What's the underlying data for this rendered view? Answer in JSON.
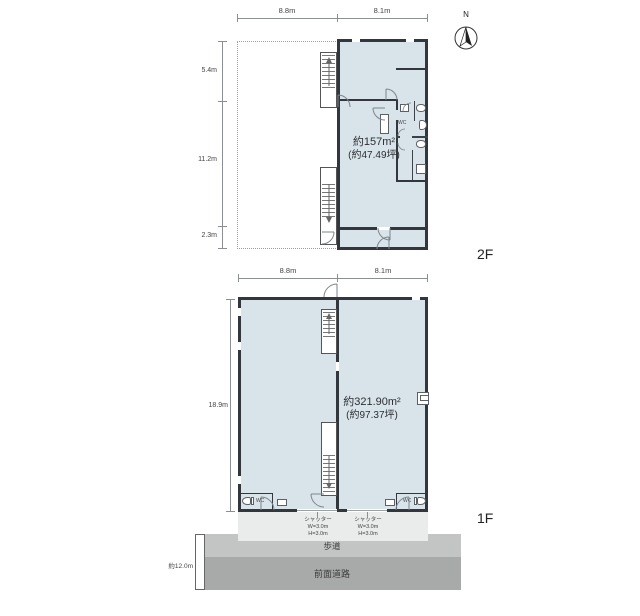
{
  "compass": {
    "north_label": "N"
  },
  "floor2": {
    "name": "2F",
    "dim_top_left": "8.8m",
    "dim_top_right": "8.1m",
    "dim_left_1": "5.4m",
    "dim_left_2": "11.2m",
    "dim_left_3": "2.3m",
    "area_m2": "約157m²",
    "area_tsubo": "(約47.49坪)",
    "wc_label": "WC"
  },
  "floor1": {
    "name": "1F",
    "dim_top_left": "8.8m",
    "dim_top_right": "8.1m",
    "dim_left": "18.9m",
    "area_m2": "約321.90m²",
    "area_tsubo": "(約97.37坪)",
    "wc_left_label": "WC",
    "wc_right_label": "WC",
    "shutter_left": {
      "l1": "シャッター",
      "l2": "W=3.0m",
      "l3": "H=3.0m"
    },
    "shutter_right": {
      "l1": "シャッター",
      "l2": "W=3.0m",
      "l3": "H=3.0m"
    }
  },
  "site": {
    "sidewalk_label": "歩道",
    "road_label": "前面道路",
    "road_width": "約12.0m"
  },
  "colors": {
    "floor_fill": "#d8e4ea",
    "wall": "#31373d",
    "apron": "#eaecec",
    "sidewalk": "#c3c5c5",
    "road": "#a8aaaa"
  }
}
